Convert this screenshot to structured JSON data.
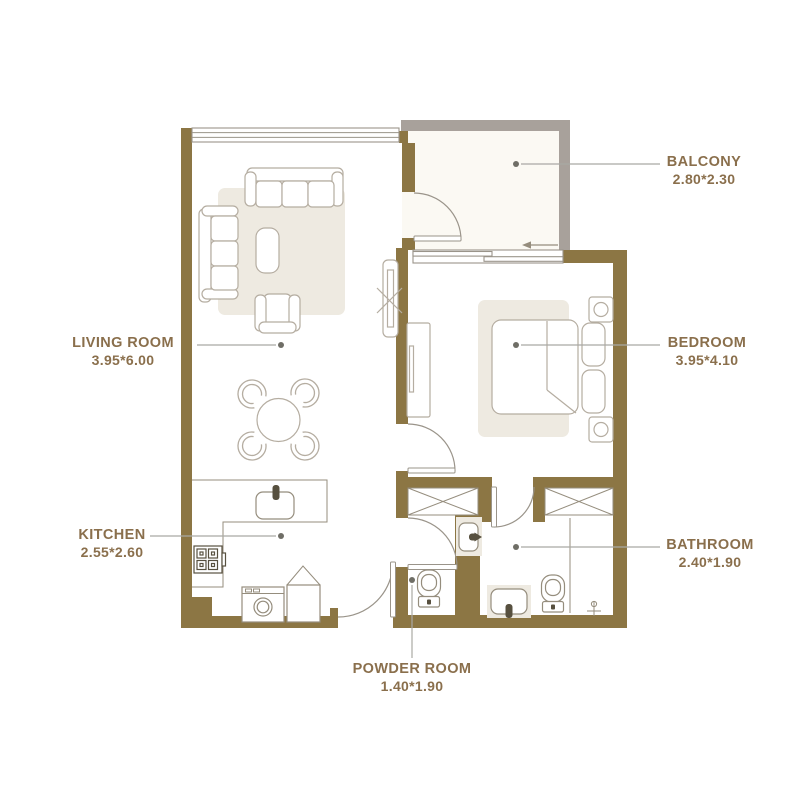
{
  "colors": {
    "wall": "#8c7644",
    "balcony_wall": "#a8a19b",
    "balcony_floor": "#fbf9f3",
    "floor": "#ffffff",
    "rug": "#eeeae1",
    "furniture_stroke": "#b5ada1",
    "fixture_stroke": "#958d7d",
    "appliance_stroke": "#57503f",
    "door_stroke": "#9a948a",
    "label_text": "#8a6f4c",
    "leader_line": "#a9a9a4",
    "leader_dot": "#6f6e66"
  },
  "rooms": [
    {
      "id": "living-room",
      "name": "LIVING ROOM",
      "dims": "3.95*6.00"
    },
    {
      "id": "kitchen",
      "name": "KITCHEN",
      "dims": "2.55*2.60"
    },
    {
      "id": "balcony",
      "name": "BALCONY",
      "dims": "2.80*2.30"
    },
    {
      "id": "bedroom",
      "name": "BEDROOM",
      "dims": "3.95*4.10"
    },
    {
      "id": "bathroom",
      "name": "BATHROOM",
      "dims": "2.40*1.90"
    },
    {
      "id": "powder-room",
      "name": "POWDER ROOM",
      "dims": "1.40*1.90"
    }
  ],
  "icons": [
    "sofa-icon",
    "loveseat-icon",
    "armchair-icon",
    "coffee-table-icon",
    "dining-table-icon",
    "dining-chair-icon",
    "tv-icon",
    "rug-icon",
    "bed-icon",
    "pillow-icon",
    "nightstand-icon",
    "wardrobe-icon",
    "closet-icon",
    "stove-icon",
    "kitchen-sink-icon",
    "washing-machine-icon",
    "kitchen-cabinet-icon",
    "toilet-icon",
    "washbasin-icon",
    "vanity-icon",
    "shower-mixer-icon",
    "door-icon",
    "sliding-window-icon",
    "window-icon",
    "leader-dot"
  ]
}
